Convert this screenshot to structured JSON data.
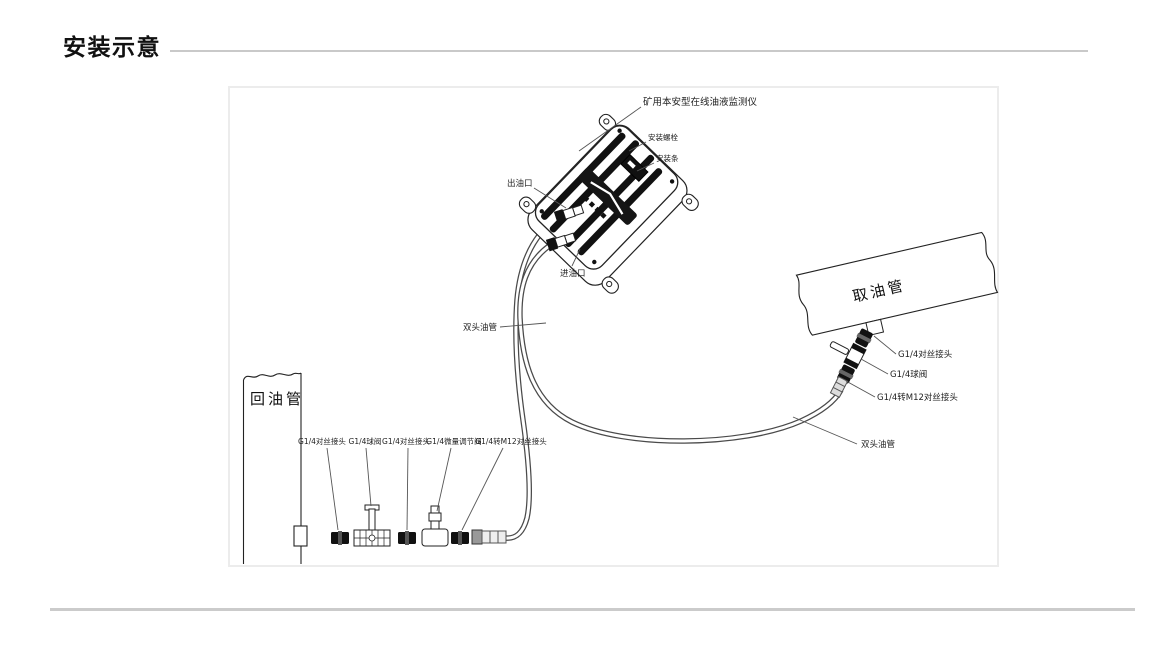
{
  "page": {
    "title": "安装示意"
  },
  "colors": {
    "ink": "#222222",
    "rule_gray": "#c9c9c9",
    "box_border": "#ececec",
    "strap_black": "#111111"
  },
  "diagram": {
    "device_label": "矿用本安型在线油液监测仪",
    "mounting_bolt_label": "安装螺栓",
    "mounting_strip_label": "安装条",
    "oil_outlet_label": "出油口",
    "oil_inlet_label": "进油口",
    "double_hose_label_mid": "双头油管",
    "double_hose_label_right": "双头油管",
    "return_pipe_label": "回油管",
    "intake_pipe_label": "取油管",
    "left_chain_labels": [
      "G1/4对丝接头",
      "G1/4球阀",
      "G1/4对丝接头",
      "G1/4微量调节阀",
      "G1/4转M12对丝接头"
    ],
    "right_chain_labels": [
      "G1/4对丝接头",
      "G1/4球阀",
      "G1/4转M12对丝接头"
    ]
  }
}
